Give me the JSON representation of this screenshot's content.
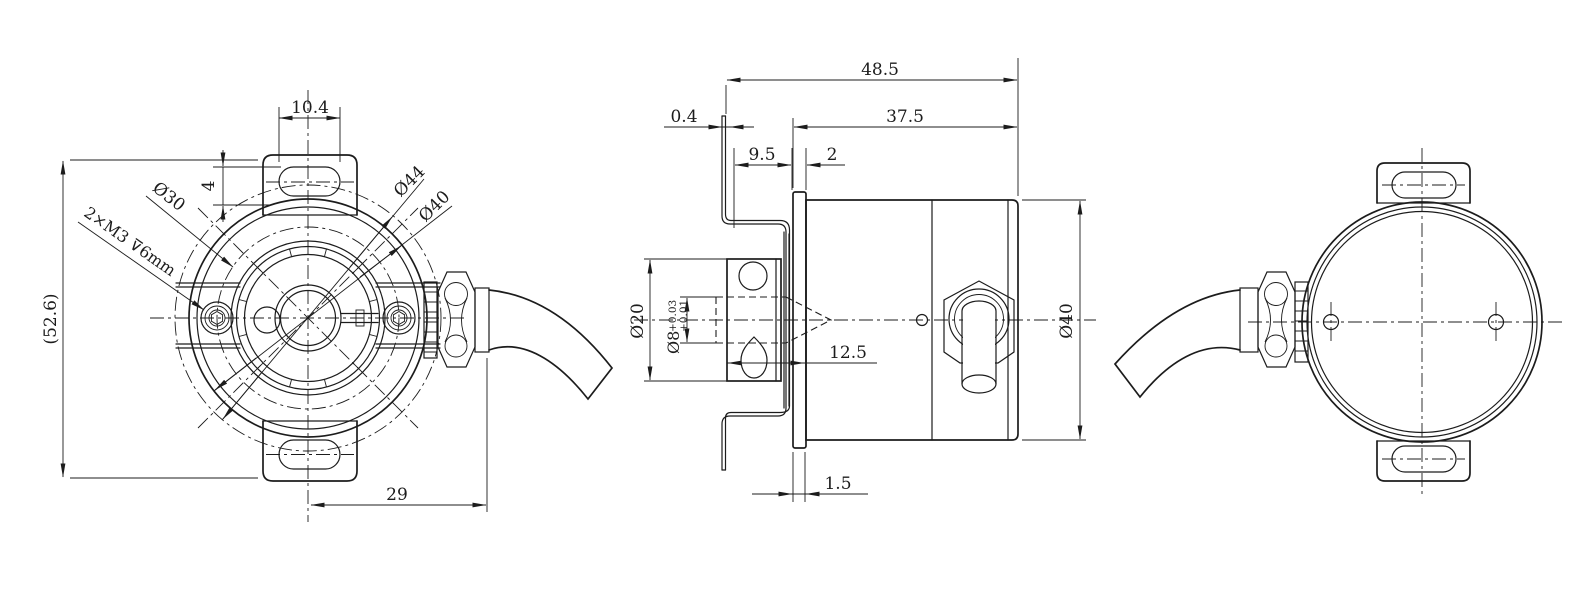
{
  "colors": {
    "background": "#ffffff",
    "line": "#1c1c1c"
  },
  "front_view": {
    "slot_width": "10.4",
    "tab_offset": "4",
    "bolt_circle_dia": "Ø30",
    "tapped_holes": "2×M3 ⊽6mm",
    "overall_height": "(52.6)",
    "cable_axis_offset": "29",
    "flange_dia": "Ø44",
    "body_dia": "Ø40"
  },
  "side_view": {
    "overall_length": "48.5",
    "bracket_thickness": "0.4",
    "body_length": "37.5",
    "hub_length": "9.5",
    "clamp_step": "2",
    "hub_dia": "Ø20",
    "shaft_dia": "Ø8",
    "shaft_tol_upper": "+0.03",
    "shaft_tol_lower": "+0.01",
    "hub_depth": "12.5",
    "clamp_disc_thickness": "1.5",
    "body_dia": "Ø40"
  }
}
